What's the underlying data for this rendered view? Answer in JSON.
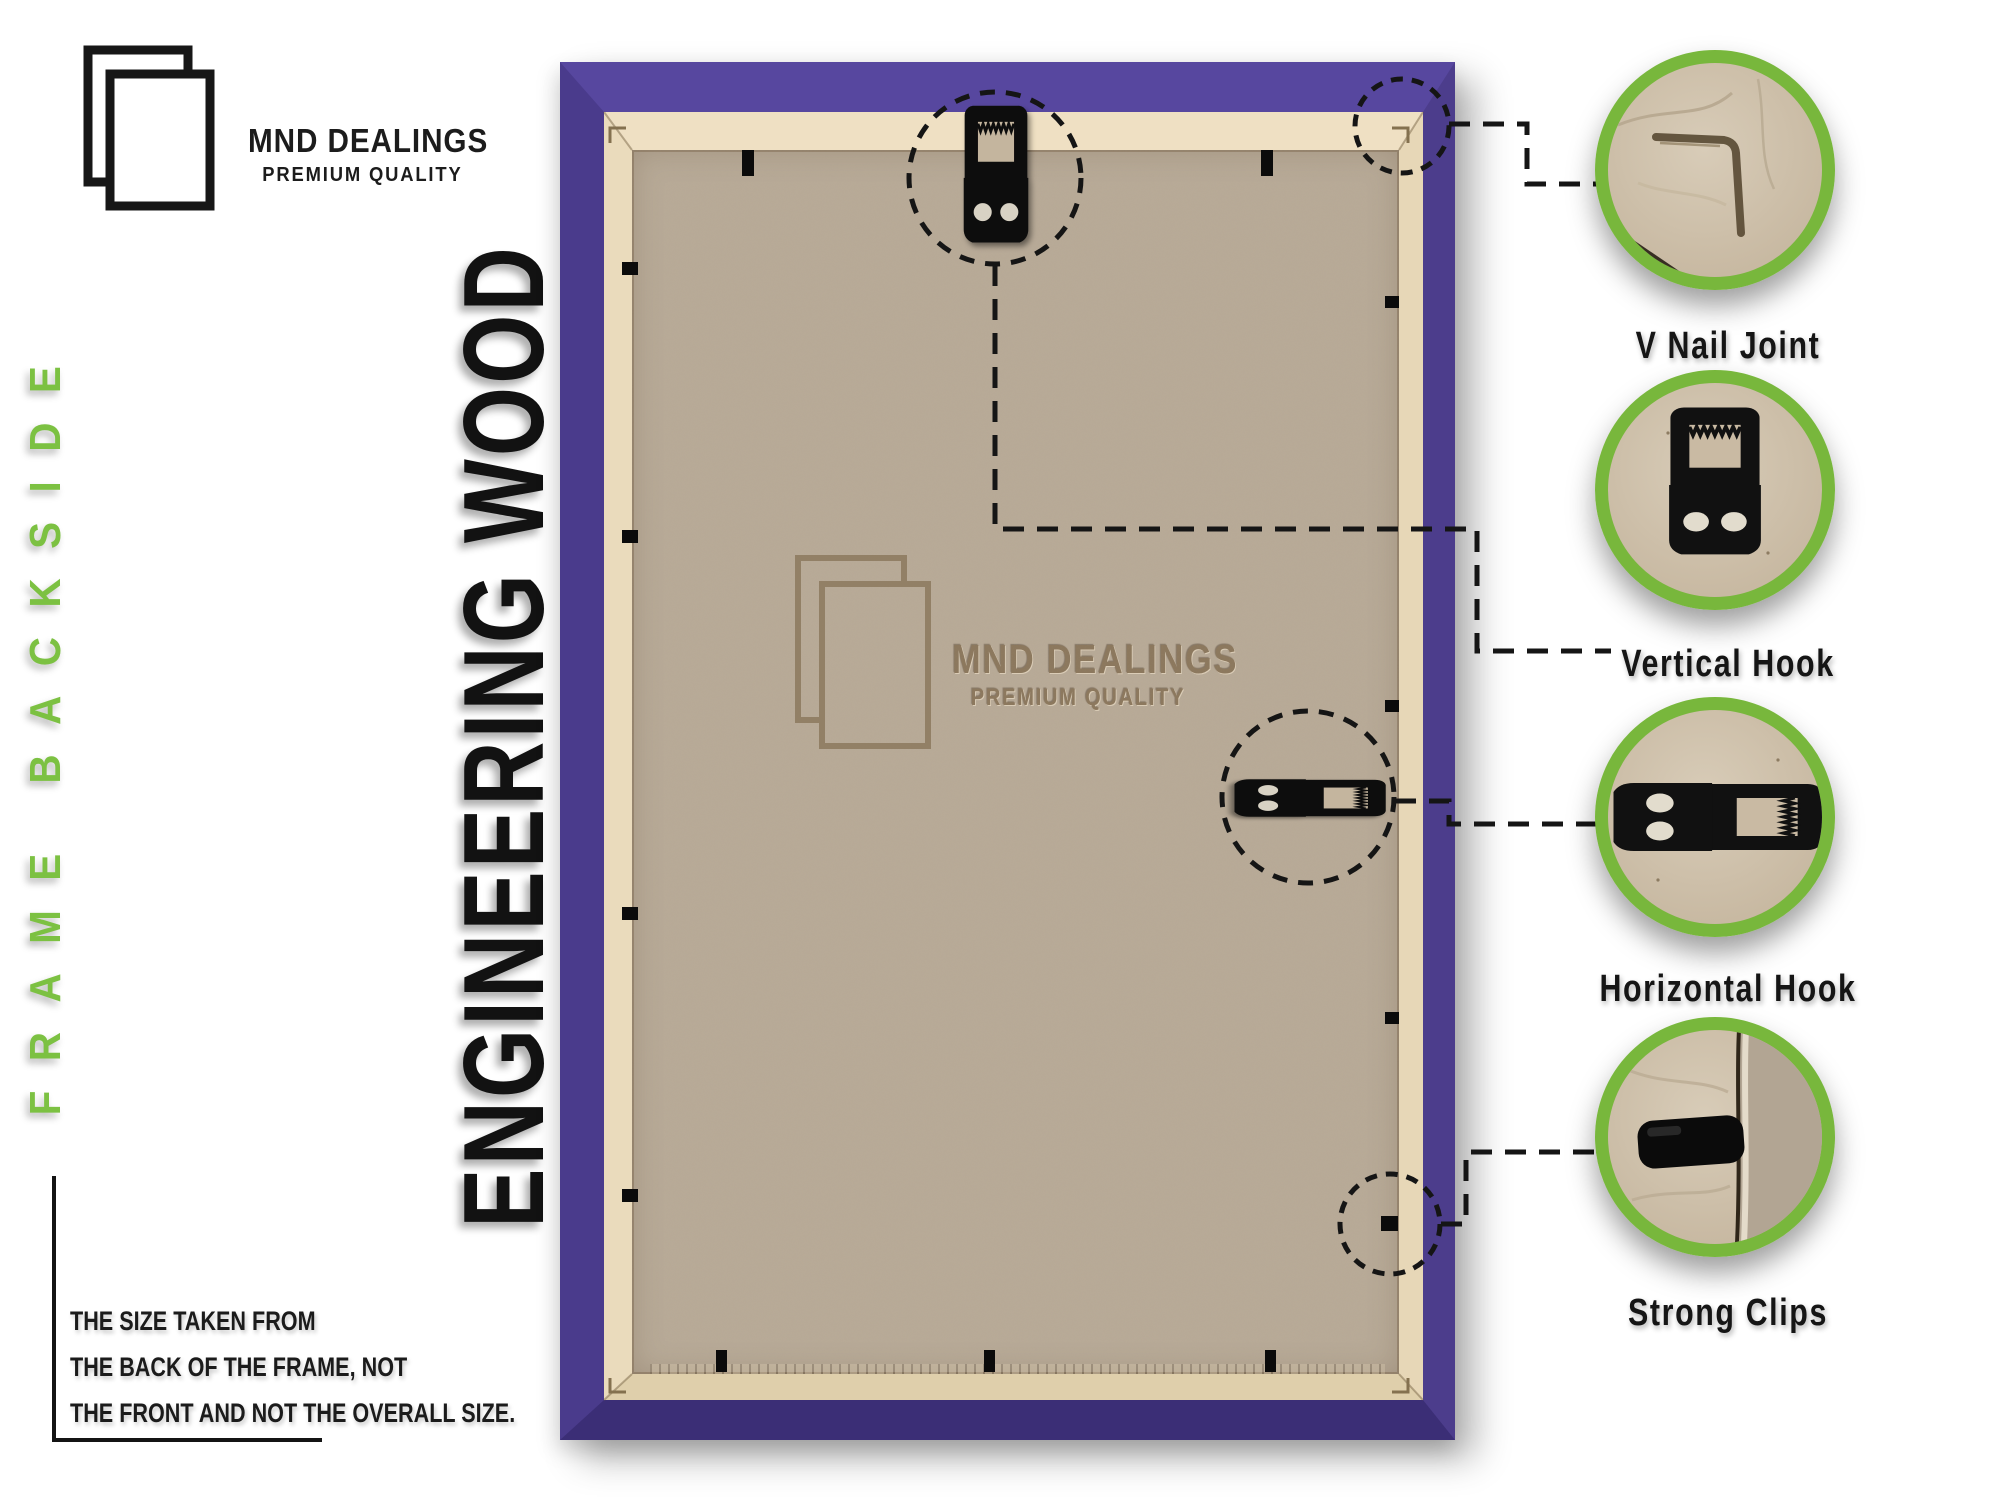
{
  "brand": {
    "name": "MND DEALINGS",
    "tagline": "PREMIUM QUALITY"
  },
  "side_label": "FRAME BACKSIDE",
  "material_label": "ENGINEERING WOOD",
  "size_note": {
    "lines": [
      "THE SIZE TAKEN FROM",
      "THE BACK OF THE FRAME, NOT",
      "THE FRONT AND NOT THE OVERALL SIZE."
    ]
  },
  "watermark": {
    "name": "MND DEALINGS",
    "tagline": "PREMIUM QUALITY"
  },
  "callouts": [
    {
      "id": "v-nail-joint",
      "label": "V Nail Joint"
    },
    {
      "id": "vertical-hook",
      "label": "Vertical Hook"
    },
    {
      "id": "horizontal-hook",
      "label": "Horizontal Hook"
    },
    {
      "id": "strong-clips",
      "label": "Strong Clips"
    }
  ],
  "colors": {
    "accent_green": "#7cc142",
    "ring_green": "#78b73c",
    "frame_purple": "#4a3b8c",
    "mdf_edge": "#eadbbc",
    "backboard": "#b8aa97",
    "ink": "#161616"
  }
}
